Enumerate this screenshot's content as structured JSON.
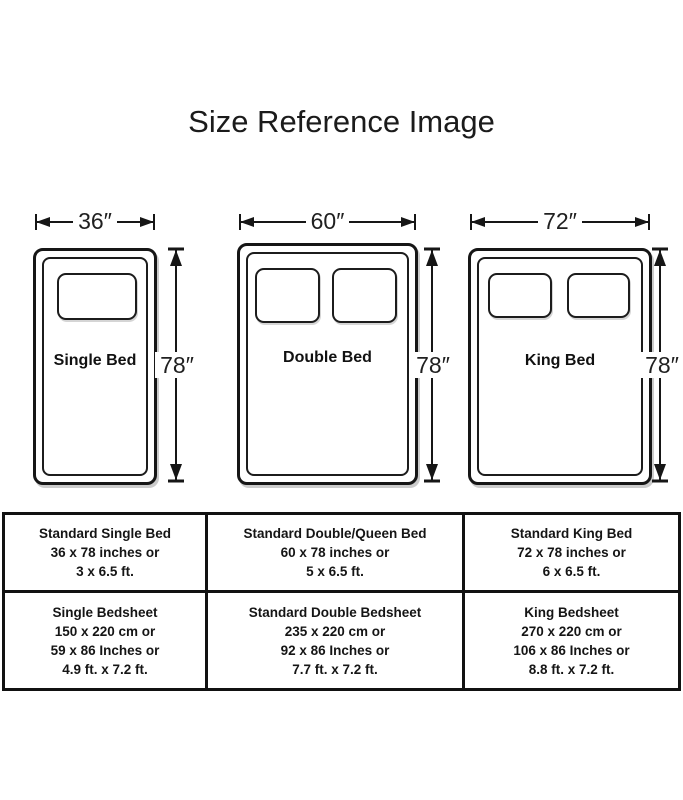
{
  "title": "Size Reference Image",
  "beds": [
    {
      "name": "Single Bed",
      "width_label": "36″",
      "height_label": "78″"
    },
    {
      "name": "Double Bed",
      "width_label": "60″",
      "height_label": "78″"
    },
    {
      "name": "King Bed",
      "width_label": "72″",
      "height_label": "78″"
    }
  ],
  "table": {
    "rows": [
      {
        "cells": [
          {
            "lines": [
              "Standard Single Bed",
              "36 x 78 inches or",
              "3 x 6.5 ft."
            ]
          },
          {
            "lines": [
              "Standard Double/Queen Bed",
              "60 x 78 inches or",
              "5 x 6.5 ft."
            ]
          },
          {
            "lines": [
              "Standard King Bed",
              "72 x 78 inches or",
              "6 x 6.5 ft."
            ]
          }
        ]
      },
      {
        "cells": [
          {
            "lines": [
              "Single Bedsheet",
              "150 x 220 cm or",
              "59 x 86 Inches or",
              "4.9 ft. x 7.2 ft."
            ]
          },
          {
            "lines": [
              "Standard Double Bedsheet",
              "235 x 220 cm or",
              "92 x 86 Inches or",
              "7.7 ft. x 7.2 ft."
            ]
          },
          {
            "lines": [
              "King Bedsheet",
              "270 x 220 cm or",
              "106 x 86 Inches or",
              "8.8 ft. x 7.2 ft."
            ]
          }
        ]
      }
    ]
  }
}
